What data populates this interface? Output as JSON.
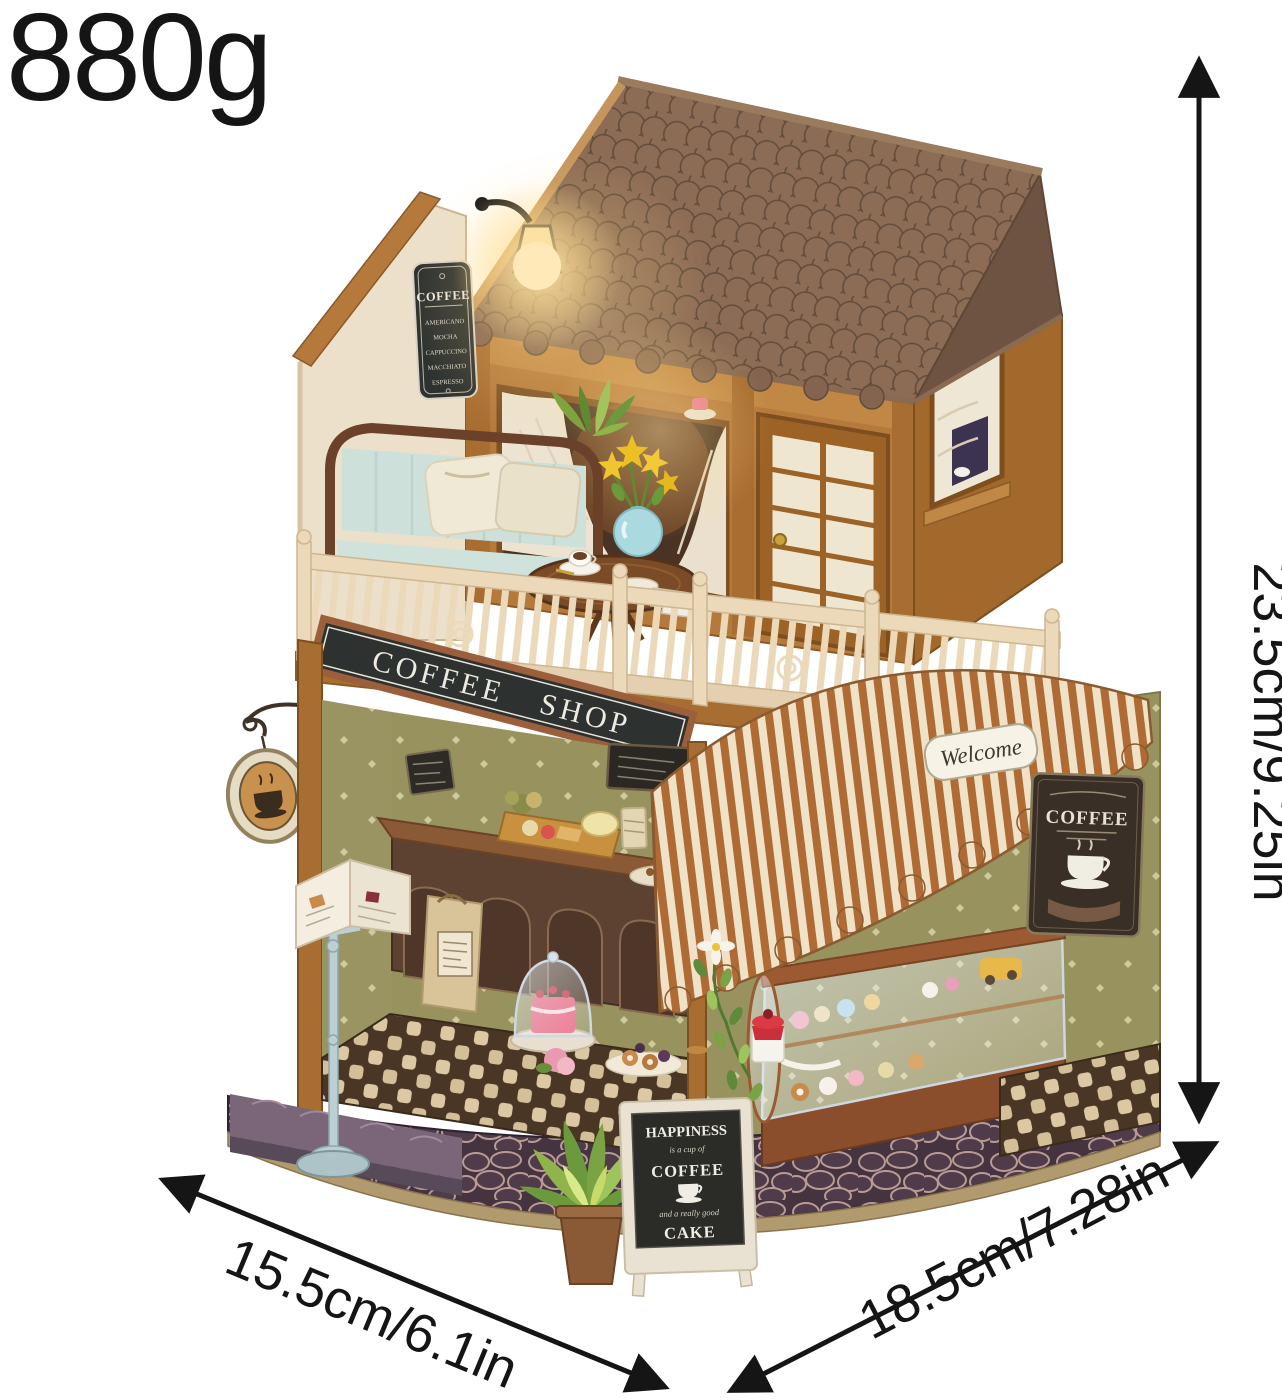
{
  "annotations": {
    "weight": "880g",
    "height": "23.5cm/9.25in",
    "base_left": "15.5cm/6.1in",
    "base_right": "18.5cm/7.28in"
  },
  "signs": {
    "shop": "COFFEE SHOP",
    "menu_board": {
      "title": "COFFEE",
      "items": [
        "AMERICANO",
        "MOCHA",
        "CAPPUCCINO",
        "MACCHIATO",
        "ESPRESSO"
      ]
    },
    "awning_sticker": "Welcome",
    "right_wall_sign": "COFFEE",
    "aframe": {
      "top": "HAPPINESS",
      "script1": "is a cup of",
      "mid": "COFFEE",
      "script2": "and a really good",
      "bottom": "CAKE"
    }
  },
  "palette": {
    "roof": "#84644e",
    "wood": "#b5793b",
    "wood_dark": "#8a5a28",
    "awning_brown": "#b06a33",
    "awning_cream": "#f0e2c8",
    "wall_olive": "#98925f",
    "sign_black": "#2d312f",
    "sofa_blue": "#cfe2dc",
    "railing_cream": "#ecd9ba",
    "annotation": "#151515"
  }
}
